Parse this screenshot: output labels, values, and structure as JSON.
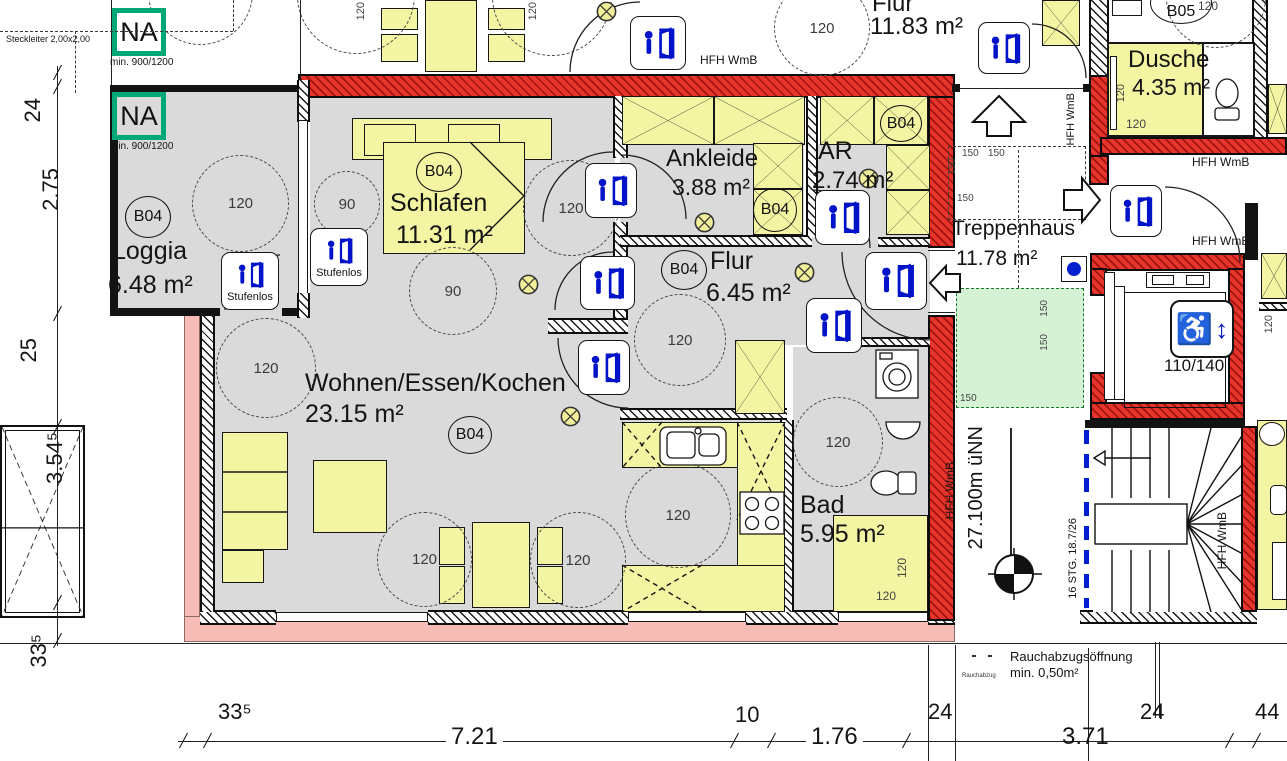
{
  "na_box": {
    "label": "NA",
    "sub": "min. 900/1200"
  },
  "steckleiter": "Steckleiter 2,00x2,00",
  "dims_left": {
    "d1": "24",
    "d2": "2.75",
    "d3": "25",
    "d4": "3.54⁵",
    "d5": "33⁵"
  },
  "dims_bottom": {
    "d1": "33⁵",
    "d2": "7.21",
    "d3": "10",
    "d4": "1.76",
    "d5": "24",
    "d6": "3.71",
    "d7": "24",
    "d8": "44"
  },
  "rooms": {
    "loggia": {
      "code": "B04",
      "name": "Loggia",
      "area": "6.48 m²"
    },
    "schlafen": {
      "code": "B04",
      "name": "Schlafen",
      "area": "11.31 m²"
    },
    "ankleide": {
      "code": "B04",
      "name": "Ankleide",
      "area": "3.88 m²"
    },
    "abstell": {
      "code": "B04",
      "name": "AR",
      "area": "2.74 m²"
    },
    "flur": {
      "code": "B04",
      "name": "Flur",
      "area": "6.45 m²"
    },
    "wohnen": {
      "code": "B04",
      "name": "Wohnen/Essen/Kochen",
      "area": "23.15 m²"
    },
    "bad": {
      "code": "B04",
      "name": "Bad",
      "area": "5.95 m²"
    },
    "flur_og": {
      "code": "B05",
      "name": "Flur",
      "area": "11.83 m²"
    },
    "dusche": {
      "code": "B05",
      "name": "Dusche",
      "area": "4.35 m²"
    },
    "treppenhaus": {
      "name": "Treppenhaus",
      "area": "11.78 m²"
    }
  },
  "labels": {
    "stufenlos": "Stufenlos",
    "hfh": "HFH WmB",
    "r120": "120",
    "r90": "90",
    "r150": "150",
    "lift": "110/140",
    "stairs_note": "16 STG. 18.7/26",
    "level": "27.100m üNN",
    "vent1": "Rauchabzugsöffnung",
    "vent2": "min. 0,50m²",
    "vent_small": "Rauchabzug"
  },
  "colors": {
    "wall_red": "#e8352b",
    "wall_pink": "#f6bcb6",
    "furniture_yellow": "#f3f5a2",
    "floor_gray": "#dadada",
    "na_green": "#00a878",
    "landing_green": "#d5f2d5",
    "icon_blue": "#0013c8"
  }
}
